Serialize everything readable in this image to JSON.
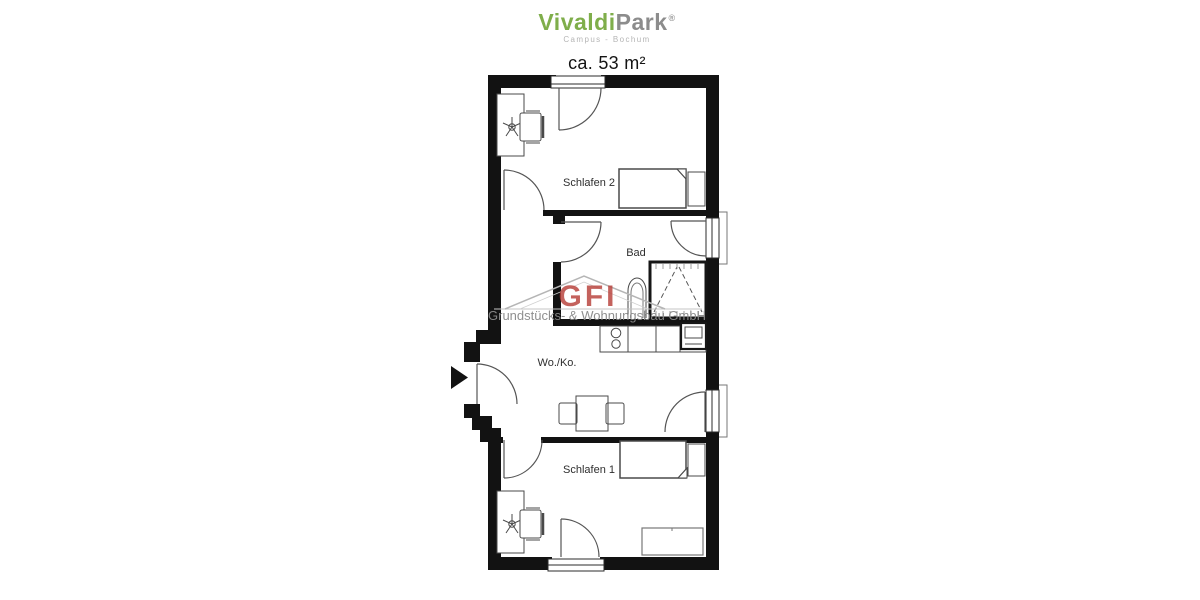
{
  "header": {
    "brand": {
      "part_green": "Vivaldi",
      "part_gray": "Park",
      "registered_mark": "®",
      "subtitle": "Campus - Bochum"
    },
    "area_label": "ca. 53 m²"
  },
  "floorplan": {
    "rooms": [
      {
        "label": "Schlafen 2"
      },
      {
        "label": "Bad"
      },
      {
        "label": "Wo./Ko."
      },
      {
        "label": "Schlafen 1"
      }
    ]
  },
  "watermark": {
    "logo": "GFI",
    "company": "Grundstücks- & Wohnungsbau GmbH"
  },
  "colors": {
    "brand_green": "#7fae4b",
    "brand_gray": "#8c8c8c",
    "watermark_red": "#b8403a",
    "wall_black": "#121212"
  }
}
